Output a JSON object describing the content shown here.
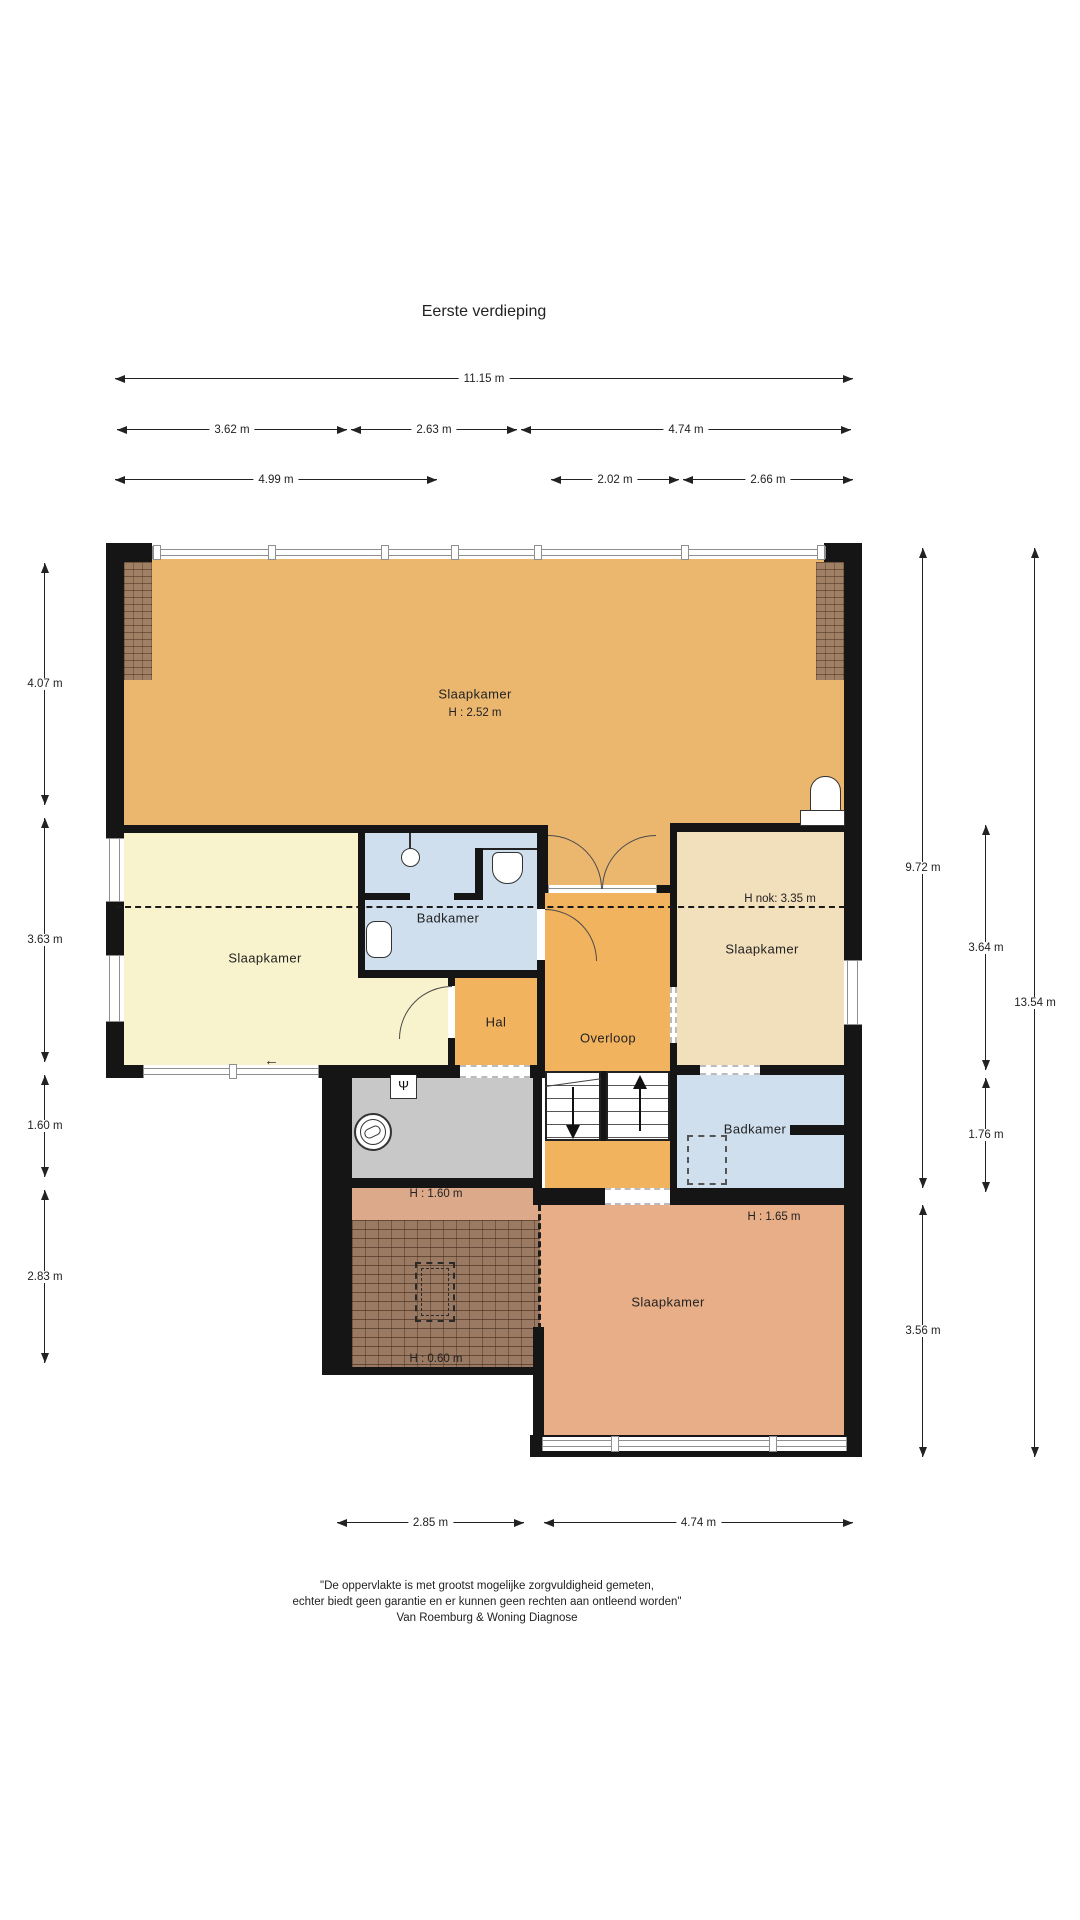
{
  "title": "Eerste verdieping",
  "rooms": {
    "slaapkamer_top": {
      "label": "Slaapkamer",
      "height": "H : 2.52 m"
    },
    "badkamer_left": {
      "label": "Badkamer"
    },
    "slaapkamer_left": {
      "label": "Slaapkamer"
    },
    "hal": {
      "label": "Hal"
    },
    "overloop": {
      "label": "Overloop"
    },
    "slaapkamer_right": {
      "label": "Slaapkamer",
      "nok": "H nok: 3.35 m"
    },
    "badkamer_right": {
      "label": "Badkamer"
    },
    "slaapkamer_bottom": {
      "label": "Slaapkamer",
      "height": "H : 1.65 m"
    },
    "berging_laag": {
      "height": "H : 1.60 m"
    },
    "dak_laag": {
      "height": "H : 0.60 m"
    }
  },
  "dimensions": {
    "top_row1": [
      "11.15 m"
    ],
    "top_row2": [
      "3.62 m",
      "2.63 m",
      "4.74 m"
    ],
    "top_row3": [
      "4.99 m",
      "2.02 m",
      "2.66 m"
    ],
    "bottom": [
      "2.85 m",
      "4.74 m"
    ],
    "left": [
      "4.07 m",
      "3.63 m",
      "1.60 m",
      "2.83 m"
    ],
    "right_inner": [
      "9.72 m",
      "3.56 m"
    ],
    "right_mid": [
      "3.64 m",
      "1.76 m"
    ],
    "right_outer": [
      "13.54 m"
    ]
  },
  "footer": {
    "line1": "\"De oppervlakte is met grootst mogelijke zorgvuldigheid gemeten,",
    "line2": "echter biedt geen garantie en er kunnen geen rechten aan ontleend worden\"",
    "line3": "Van Roemburg & Woning Diagnose"
  },
  "colors": {
    "wall": "#151515",
    "room-orange": "#ebb76f",
    "room-landing": "#f2b35e",
    "room-yellow": "#f9f3cd",
    "room-blue": "#cfdfee",
    "room-beige": "#f2dfbb",
    "room-terra": "#e7ae88",
    "room-gray": "#c8c8c8",
    "terra-light": "#dca98a"
  }
}
